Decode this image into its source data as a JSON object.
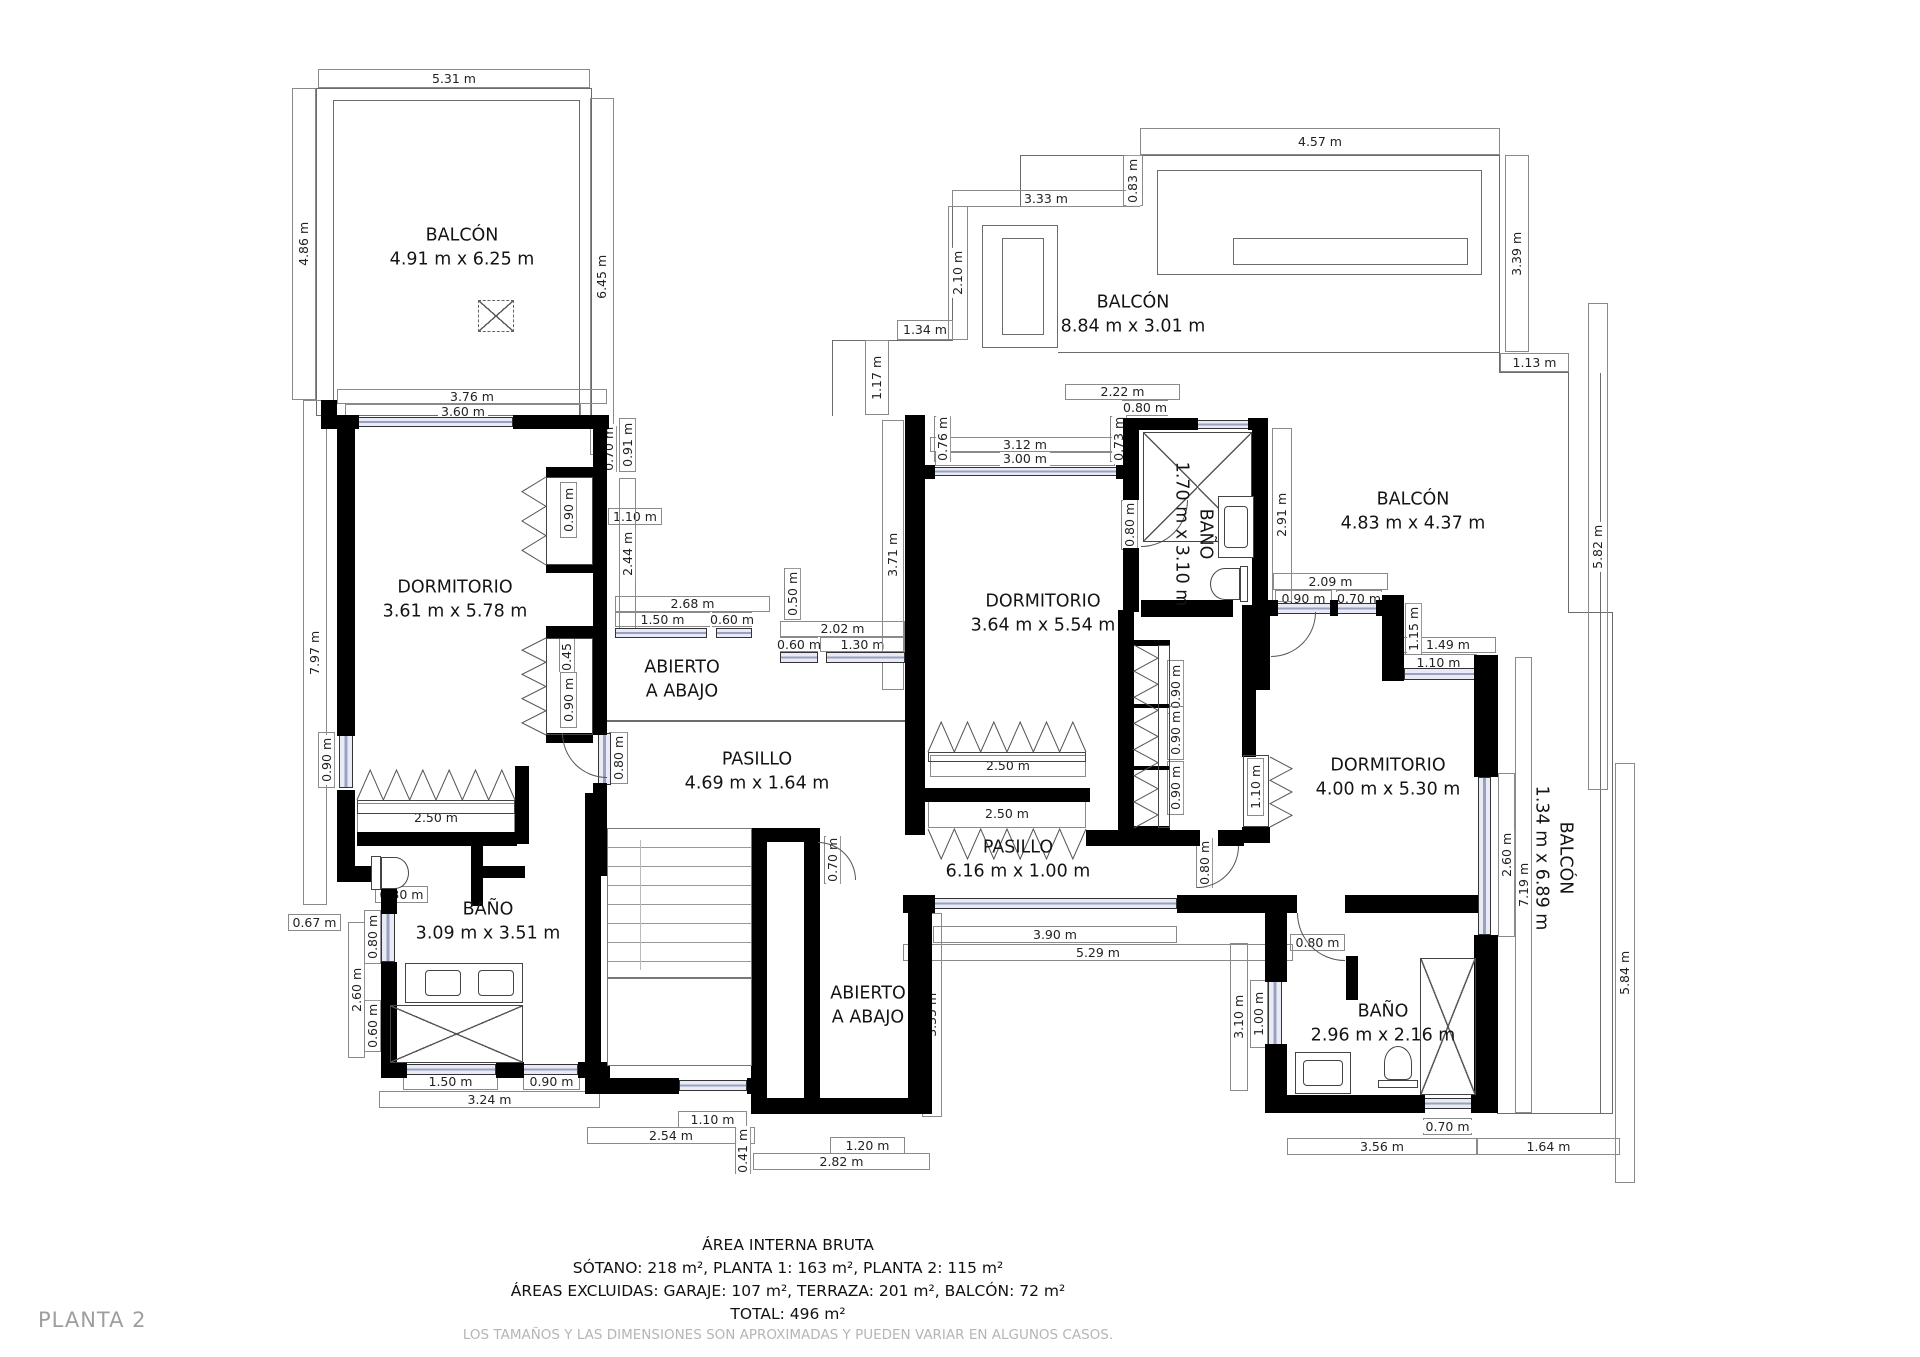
{
  "page": {
    "title": "PLANTA 2"
  },
  "footer": {
    "line1": "ÁREA INTERNA BRUTA",
    "line2": "SÓTANO: 218 m², PLANTA 1: 163 m², PLANTA 2: 115 m²",
    "line3": "ÁREAS EXCLUIDAS: GARAJE: 107 m², TERRAZA: 201 m², BALCÓN: 72 m²",
    "line4": "TOTAL: 496 m²",
    "line5": "LOS TAMAÑOS Y LAS DIMENSIONES SON APROXIMADAS Y PUEDEN VARIAR EN ALGUNOS CASOS."
  },
  "colors": {
    "wall": "#000000",
    "dimline": "#8a8a8a",
    "window": "#e8ebf6",
    "muted": "#b5b5b5"
  },
  "rooms": [
    {
      "name": "BALCÓN",
      "size": "4.91 m x 6.25 m",
      "x": 462,
      "y": 248,
      "rot": false
    },
    {
      "name": "BALCÓN",
      "size": "8.84 m x 3.01 m",
      "x": 1133,
      "y": 315,
      "rot": false
    },
    {
      "name": "BALCÓN",
      "size": "4.83 m x 4.37 m",
      "x": 1413,
      "y": 512,
      "rot": false
    },
    {
      "name": "DORMITORIO",
      "size": "3.61 m x 5.78 m",
      "x": 455,
      "y": 600,
      "rot": false
    },
    {
      "name": "DORMITORIO",
      "size": "3.64 m x 5.54 m",
      "x": 1043,
      "y": 614,
      "rot": false
    },
    {
      "name": "DORMITORIO",
      "size": "4.00 m x 5.30 m",
      "x": 1388,
      "y": 778,
      "rot": false
    },
    {
      "name": "ABIERTO",
      "size": "A ABAJO",
      "x": 682,
      "y": 680,
      "rot": false
    },
    {
      "name": "PASILLO",
      "size": "4.69 m x 1.64 m",
      "x": 757,
      "y": 772,
      "rot": false
    },
    {
      "name": "PASILLO",
      "size": "6.16 m x 1.00 m",
      "x": 1018,
      "y": 860,
      "rot": false
    },
    {
      "name": "BAÑO",
      "size": "3.09 m x 3.51 m",
      "x": 488,
      "y": 922,
      "rot": false
    },
    {
      "name": "ABIERTO",
      "size": "A ABAJO",
      "x": 868,
      "y": 1006,
      "rot": false
    },
    {
      "name": "BAÑO",
      "size": "2.96 m x 2.16 m",
      "x": 1383,
      "y": 1024,
      "rot": false
    },
    {
      "name": "BAÑO",
      "size": "1.70 m x 3.10 m",
      "x": 1193,
      "y": 534,
      "rot": true
    },
    {
      "name": "BALCÓN",
      "size": "1.34 m x 6.89 m",
      "x": 1553,
      "y": 858,
      "rot": true
    }
  ],
  "dims": [
    [
      "5.31 m",
      318,
      69,
      272,
      19,
      "h"
    ],
    [
      "3.76 m",
      337,
      389,
      270,
      15,
      "h"
    ],
    [
      "3.60 m",
      345,
      404,
      236,
      15,
      "h"
    ],
    [
      "4.57 m",
      1140,
      128,
      360,
      27,
      "h"
    ],
    [
      "3.33 m",
      952,
      190,
      188,
      17,
      "h"
    ],
    [
      "1.34 m",
      897,
      320,
      56,
      20,
      "h"
    ],
    [
      "2.22 m",
      1065,
      384,
      115,
      16,
      "h"
    ],
    [
      "0.80 m",
      1122,
      400,
      46,
      16,
      "h"
    ],
    [
      "3.12 m",
      930,
      437,
      190,
      15,
      "h"
    ],
    [
      "3.00 m",
      935,
      452,
      180,
      14,
      "h"
    ],
    [
      "1.13 m",
      1500,
      353,
      69,
      19,
      "h"
    ],
    [
      "2.68 m",
      615,
      596,
      155,
      16,
      "h"
    ],
    [
      "1.50 m",
      615,
      612,
      95,
      15,
      "h"
    ],
    [
      "0.60 m",
      712,
      612,
      40,
      15,
      "h"
    ],
    [
      "2.02 m",
      780,
      621,
      125,
      16,
      "h"
    ],
    [
      "0.60 m",
      780,
      637,
      38,
      15,
      "h"
    ],
    [
      "1.30 m",
      820,
      637,
      85,
      15,
      "h"
    ],
    [
      "1.10 m",
      608,
      508,
      54,
      17,
      "h"
    ],
    [
      "2.09 m",
      1273,
      573,
      115,
      17,
      "h"
    ],
    [
      "0.90 m",
      1275,
      590,
      57,
      17,
      "h"
    ],
    [
      "0.70 m",
      1336,
      590,
      46,
      17,
      "h"
    ],
    [
      "1.49 m",
      1400,
      637,
      96,
      16,
      "h"
    ],
    [
      "1.10 m",
      1400,
      654,
      77,
      17,
      "h"
    ],
    [
      "2.50 m",
      930,
      755,
      156,
      22,
      "h"
    ],
    [
      "2.50 m",
      928,
      800,
      158,
      28,
      "h"
    ],
    [
      "2.50 m",
      357,
      803,
      158,
      30,
      "h"
    ],
    [
      "0.30 m",
      375,
      886,
      53,
      17,
      "h"
    ],
    [
      "0.67 m",
      288,
      914,
      53,
      17,
      "h"
    ],
    [
      "1.50 m",
      403,
      1073,
      95,
      17,
      "h"
    ],
    [
      "0.90 m",
      523,
      1073,
      57,
      17,
      "h"
    ],
    [
      "3.24 m",
      379,
      1091,
      221,
      17,
      "h"
    ],
    [
      "1.10 m",
      678,
      1111,
      69,
      17,
      "h"
    ],
    [
      "2.54 m",
      587,
      1127,
      168,
      17,
      "h"
    ],
    [
      "1.20 m",
      830,
      1137,
      75,
      17,
      "h"
    ],
    [
      "2.82 m",
      753,
      1153,
      177,
      17,
      "h"
    ],
    [
      "3.90 m",
      933,
      926,
      244,
      17,
      "h"
    ],
    [
      "5.29 m",
      903,
      944,
      390,
      17,
      "h"
    ],
    [
      "0.80 m",
      1290,
      934,
      55,
      17,
      "h"
    ],
    [
      "0.70 m",
      1423,
      1118,
      49,
      17,
      "h"
    ],
    [
      "3.56 m",
      1287,
      1138,
      190,
      17,
      "h"
    ],
    [
      "1.64 m",
      1477,
      1138,
      143,
      17,
      "h"
    ],
    [
      "4.86 m",
      292,
      88,
      24,
      312,
      "v"
    ],
    [
      "6.45 m",
      590,
      98,
      24,
      357,
      "v"
    ],
    [
      "7.97 m",
      303,
      400,
      24,
      505,
      "v"
    ],
    [
      "0.90 m",
      318,
      732,
      17,
      56,
      "v"
    ],
    [
      "0.70 m",
      600,
      426,
      17,
      46,
      "v"
    ],
    [
      "0.91 m",
      619,
      418,
      17,
      54,
      "v"
    ],
    [
      "0.90 m",
      560,
      482,
      17,
      56,
      "v"
    ],
    [
      "0.45 m",
      559,
      626,
      16,
      46,
      "v"
    ],
    [
      "0.90 m",
      560,
      672,
      17,
      56,
      "v"
    ],
    [
      "2.44 m",
      619,
      478,
      17,
      152,
      "v"
    ],
    [
      "0.50 m",
      784,
      568,
      17,
      52,
      "v"
    ],
    [
      "0.76 m",
      934,
      416,
      17,
      46,
      "v"
    ],
    [
      "0.73 m",
      1110,
      416,
      17,
      46,
      "v"
    ],
    [
      "2.10 m",
      948,
      206,
      20,
      134,
      "v"
    ],
    [
      "0.83 m",
      1123,
      155,
      20,
      51,
      "v"
    ],
    [
      "1.17 m",
      865,
      340,
      24,
      75,
      "v"
    ],
    [
      "3.71 m",
      882,
      420,
      22,
      270,
      "v"
    ],
    [
      "3.39 m",
      1505,
      155,
      24,
      197,
      "v"
    ],
    [
      "2.91 m",
      1272,
      428,
      20,
      174,
      "v"
    ],
    [
      "0.80 m",
      1121,
      500,
      17,
      50,
      "v"
    ],
    [
      "0.80 m",
      1245,
      618,
      17,
      50,
      "v"
    ],
    [
      "0.90 m",
      1167,
      660,
      17,
      54,
      "v"
    ],
    [
      "0.90 m",
      1167,
      706,
      17,
      54,
      "v"
    ],
    [
      "0.90 m",
      1167,
      761,
      17,
      54,
      "v"
    ],
    [
      "1.10 m",
      1247,
      758,
      17,
      58,
      "v"
    ],
    [
      "0.80 m",
      1196,
      838,
      17,
      50,
      "v"
    ],
    [
      "1.15 m",
      1405,
      603,
      17,
      52,
      "v"
    ],
    [
      "5.82 m",
      1588,
      303,
      20,
      487,
      "v"
    ],
    [
      "2.60 m",
      1498,
      773,
      17,
      164,
      "v"
    ],
    [
      "7.19 m",
      1515,
      657,
      17,
      456,
      "v"
    ],
    [
      "5.84 m",
      1615,
      763,
      20,
      420,
      "v"
    ],
    [
      "0.80 m",
      364,
      910,
      17,
      54,
      "v"
    ],
    [
      "2.60 m",
      348,
      922,
      17,
      136,
      "v"
    ],
    [
      "0.60 m",
      364,
      1000,
      17,
      52,
      "v"
    ],
    [
      "3.35 m",
      922,
      913,
      20,
      204,
      "v"
    ],
    [
      "0.41 m",
      735,
      1128,
      16,
      46,
      "v"
    ],
    [
      "0.70 m",
      824,
      836,
      17,
      48,
      "v"
    ],
    [
      "0.80 m",
      609,
      732,
      19,
      52,
      "v"
    ],
    [
      "3.10 m",
      1230,
      943,
      18,
      148,
      "v"
    ],
    [
      "1.00 m",
      1250,
      980,
      18,
      68,
      "v"
    ]
  ],
  "walls": [
    [
      337,
      415,
      22,
      14
    ],
    [
      513,
      415,
      96,
      14
    ],
    [
      337,
      429,
      18,
      307
    ],
    [
      337,
      790,
      18,
      82
    ],
    [
      337,
      866,
      60,
      16
    ],
    [
      381,
      882,
      16,
      32
    ],
    [
      381,
      962,
      16,
      102
    ],
    [
      381,
      1062,
      26,
      16
    ],
    [
      496,
      1062,
      28,
      16
    ],
    [
      578,
      1062,
      32,
      16
    ],
    [
      593,
      429,
      14,
      40
    ],
    [
      593,
      467,
      14,
      268
    ],
    [
      593,
      783,
      14,
      93
    ],
    [
      546,
      467,
      47,
      11
    ],
    [
      546,
      564,
      47,
      9
    ],
    [
      546,
      626,
      47,
      12
    ],
    [
      546,
      733,
      47,
      10
    ],
    [
      515,
      766,
      14,
      78
    ],
    [
      357,
      832,
      160,
      14
    ],
    [
      471,
      846,
      12,
      60
    ],
    [
      483,
      866,
      42,
      12
    ],
    [
      585,
      793,
      16,
      287
    ],
    [
      585,
      1078,
      94,
      16
    ],
    [
      747,
      1078,
      8,
      16
    ],
    [
      751,
      828,
      16,
      286
    ],
    [
      804,
      828,
      16,
      286
    ],
    [
      751,
      828,
      69,
      14
    ],
    [
      751,
      1098,
      69,
      16
    ],
    [
      820,
      1098,
      112,
      16
    ],
    [
      908,
      895,
      24,
      219
    ],
    [
      905,
      415,
      20,
      420
    ],
    [
      925,
      465,
      10,
      14
    ],
    [
      1116,
      465,
      10,
      14
    ],
    [
      925,
      788,
      165,
      14
    ],
    [
      1123,
      418,
      16,
      82
    ],
    [
      1123,
      548,
      16,
      64
    ],
    [
      1123,
      418,
      75,
      12
    ],
    [
      1248,
      418,
      20,
      12
    ],
    [
      1252,
      418,
      16,
      194
    ],
    [
      1141,
      600,
      92,
      17
    ],
    [
      1118,
      610,
      16,
      224
    ],
    [
      1242,
      605,
      28,
      85
    ],
    [
      1242,
      688,
      14,
      69
    ],
    [
      1242,
      827,
      28,
      16
    ],
    [
      1086,
      830,
      114,
      16
    ],
    [
      1218,
      830,
      26,
      16
    ],
    [
      1268,
      600,
      10,
      16
    ],
    [
      1330,
      600,
      8,
      16
    ],
    [
      1376,
      600,
      8,
      16
    ],
    [
      1382,
      595,
      22,
      86
    ],
    [
      1474,
      655,
      24,
      122
    ],
    [
      1474,
      935,
      24,
      162
    ],
    [
      1476,
      1095,
      22,
      18
    ],
    [
      903,
      895,
      32,
      18
    ],
    [
      1177,
      895,
      120,
      18
    ],
    [
      1345,
      895,
      133,
      18
    ],
    [
      1265,
      895,
      22,
      87
    ],
    [
      1265,
      1044,
      22,
      69
    ],
    [
      1265,
      1095,
      160,
      18
    ],
    [
      1471,
      1095,
      27,
      18
    ],
    [
      1346,
      956,
      12,
      44
    ],
    [
      321,
      400,
      16,
      29
    ],
    [
      1134,
      640,
      36,
      6
    ],
    [
      1134,
      704,
      36,
      4
    ],
    [
      1134,
      766,
      36,
      4
    ],
    [
      1134,
      826,
      36,
      6
    ]
  ],
  "windows": [
    [
      357,
      417,
      156,
      10
    ],
    [
      339,
      734,
      14,
      54
    ],
    [
      381,
      912,
      14,
      50
    ],
    [
      405,
      1064,
      91,
      11
    ],
    [
      522,
      1064,
      56,
      11
    ],
    [
      679,
      1080,
      68,
      11
    ],
    [
      828,
      1100,
      78,
      11
    ],
    [
      615,
      628,
      92,
      10
    ],
    [
      716,
      628,
      36,
      10
    ],
    [
      780,
      652,
      38,
      11
    ],
    [
      826,
      652,
      79,
      11
    ],
    [
      933,
      467,
      185,
      9
    ],
    [
      1196,
      420,
      54,
      9
    ],
    [
      1276,
      603,
      56,
      11
    ],
    [
      1336,
      603,
      42,
      11
    ],
    [
      1404,
      668,
      72,
      12
    ],
    [
      1478,
      777,
      13,
      158
    ],
    [
      933,
      898,
      244,
      11
    ],
    [
      1268,
      980,
      14,
      66
    ],
    [
      1423,
      1098,
      50,
      11
    ],
    [
      595,
      431,
      10,
      38
    ],
    [
      598,
      733,
      13,
      52
    ]
  ],
  "outlines": [
    [
      316,
      88,
      276,
      328
    ],
    [
      333,
      100,
      247,
      316
    ],
    [
      1020,
      155,
      480,
      1
    ],
    [
      1020,
      155,
      1,
      52
    ],
    [
      952,
      206,
      69,
      1
    ],
    [
      952,
      206,
      1,
      135
    ],
    [
      832,
      340,
      121,
      1
    ],
    [
      832,
      340,
      1,
      76
    ],
    [
      1499,
      155,
      1,
      198
    ],
    [
      1058,
      352,
      442,
      1
    ],
    [
      1499,
      352,
      1,
      21
    ],
    [
      1568,
      373,
      1,
      240
    ],
    [
      1499,
      372,
      70,
      1
    ],
    [
      1568,
      612,
      45,
      1
    ],
    [
      1612,
      612,
      1,
      501
    ],
    [
      1497,
      1113,
      116,
      1
    ],
    [
      1600,
      373,
      1,
      740
    ],
    [
      982,
      225,
      76,
      123
    ],
    [
      1002,
      238,
      42,
      97
    ],
    [
      1157,
      170,
      325,
      105
    ],
    [
      1233,
      238,
      235,
      27
    ],
    [
      607,
      720,
      298,
      2
    ],
    [
      607,
      828,
      145,
      1
    ]
  ],
  "closet_boxes": [
    [
      546,
      477,
      47,
      88
    ],
    [
      546,
      638,
      47,
      97
    ],
    [
      357,
      800,
      158,
      14
    ],
    [
      928,
      752,
      158,
      10
    ],
    [
      1158,
      645,
      12,
      183
    ],
    [
      1243,
      755,
      26,
      72
    ],
    [
      675,
      828,
      77,
      150
    ]
  ],
  "zigzags": [
    {
      "x": 522,
      "y": 477,
      "w": 24,
      "h": 88,
      "dir": "left"
    },
    {
      "x": 522,
      "y": 638,
      "w": 24,
      "h": 97,
      "dir": "left"
    },
    {
      "x": 357,
      "y": 770,
      "w": 158,
      "h": 30,
      "dir": "up"
    },
    {
      "x": 928,
      "y": 722,
      "w": 158,
      "h": 30,
      "dir": "up"
    },
    {
      "x": 928,
      "y": 829,
      "w": 158,
      "h": 30,
      "dir": "down"
    },
    {
      "x": 1134,
      "y": 645,
      "w": 24,
      "h": 183,
      "dir": "right"
    },
    {
      "x": 1270,
      "y": 757,
      "w": 22,
      "h": 70,
      "dir": "right"
    }
  ],
  "doors": [
    {
      "x": 562,
      "y": 733,
      "s": 45,
      "c": "bl"
    },
    {
      "x": 1141,
      "y": 500,
      "s": 47,
      "c": "br"
    },
    {
      "x": 1271,
      "y": 612,
      "s": 45,
      "c": "br"
    },
    {
      "x": 1197,
      "y": 846,
      "s": 42,
      "c": "br"
    },
    {
      "x": 1297,
      "y": 913,
      "s": 48,
      "c": "bl"
    },
    {
      "x": 818,
      "y": 842,
      "s": 38,
      "c": "tr"
    }
  ],
  "stairs": {
    "steps_area": [
      607,
      828,
      145,
      150
    ],
    "landing": [
      607,
      978,
      145,
      88
    ],
    "arrow_x": 640
  },
  "fixtures": {
    "skylight": [
      478,
      300,
      36,
      32
    ],
    "showers": [
      [
        390,
        1005,
        133,
        58
      ],
      [
        1143,
        432,
        109,
        110
      ],
      [
        1420,
        958,
        56,
        137
      ]
    ],
    "vanities": [
      {
        "box": [
          405,
          963,
          118,
          40
        ],
        "sinks": [
          [
            425,
            970,
            36,
            26
          ],
          [
            478,
            970,
            36,
            26
          ]
        ]
      },
      {
        "box": [
          1218,
          496,
          36,
          62
        ],
        "sinks": [
          [
            1224,
            506,
            24,
            42
          ]
        ]
      },
      {
        "box": [
          1295,
          1052,
          56,
          42
        ],
        "sinks": [
          [
            1303,
            1060,
            40,
            26
          ]
        ]
      }
    ],
    "toilets": [
      {
        "tank": [
          371,
          856,
          10,
          34
        ],
        "bowl": [
          381,
          857,
          28,
          32
        ],
        "dir": "right"
      },
      {
        "tank": [
          1240,
          566,
          8,
          36
        ],
        "bowl": [
          1210,
          568,
          30,
          32
        ],
        "dir": "left"
      },
      {
        "tank": [
          1378,
          1080,
          40,
          8
        ],
        "bowl": [
          1384,
          1046,
          28,
          34
        ],
        "dir": "up"
      }
    ]
  }
}
